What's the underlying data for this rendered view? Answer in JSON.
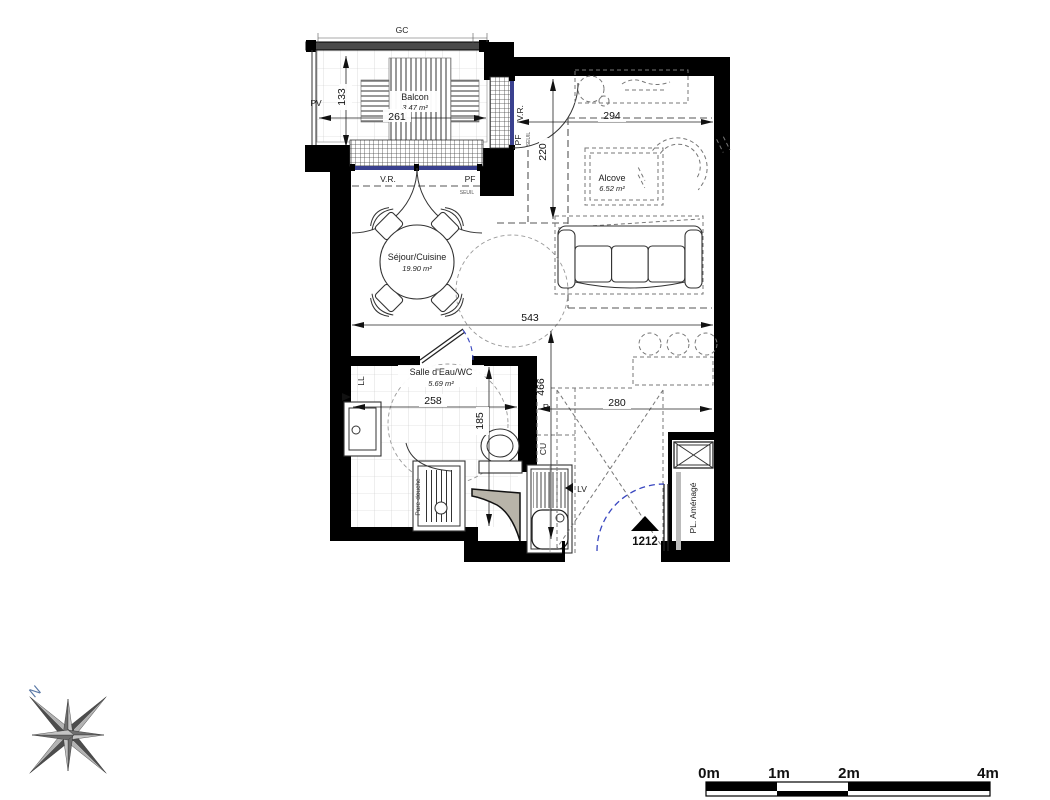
{
  "rooms": {
    "balcon": {
      "name": "Balcon",
      "area": "3.47 m²"
    },
    "sejour": {
      "name": "Séjour/Cuisine",
      "area": "19.90 m²"
    },
    "alcove": {
      "name": "Alcove",
      "area": "6.52 m²"
    },
    "salle_eau": {
      "name": "Salle d'Eau/WC",
      "area": "5.69 m²"
    },
    "placard": {
      "name": "PL. Aménagé"
    }
  },
  "dimensions": {
    "gc": "GC",
    "pv": "PV",
    "balcony_width": "261",
    "balcony_depth": "133",
    "alcove_width": "294",
    "balcony_door": "220",
    "living_width": "543",
    "bathroom_width": "258",
    "bathroom_depth": "185",
    "kitchen_strip": "466",
    "entrance_width": "280"
  },
  "openings": {
    "vr_main": "V.R.",
    "pf_main": "PF",
    "seuil_main": "SEUIL",
    "vr_side": "V.R.",
    "pf_side": "PF",
    "seuil_side": "SEUIL"
  },
  "equipment": {
    "ll": "LL",
    "pare_douche": "Pare-douche",
    "r": "R",
    "cu": "CU",
    "lv": "LV"
  },
  "entrance": {
    "unit_number": "1212"
  },
  "compass": {
    "north_label": "N"
  },
  "scale_bar": {
    "labels": [
      "0m",
      "1m",
      "2m",
      "4m"
    ]
  },
  "colors": {
    "wall": "#000000",
    "window": "#3a418f",
    "door_arc": "#3947c0",
    "duct": "#b8b4a9"
  }
}
